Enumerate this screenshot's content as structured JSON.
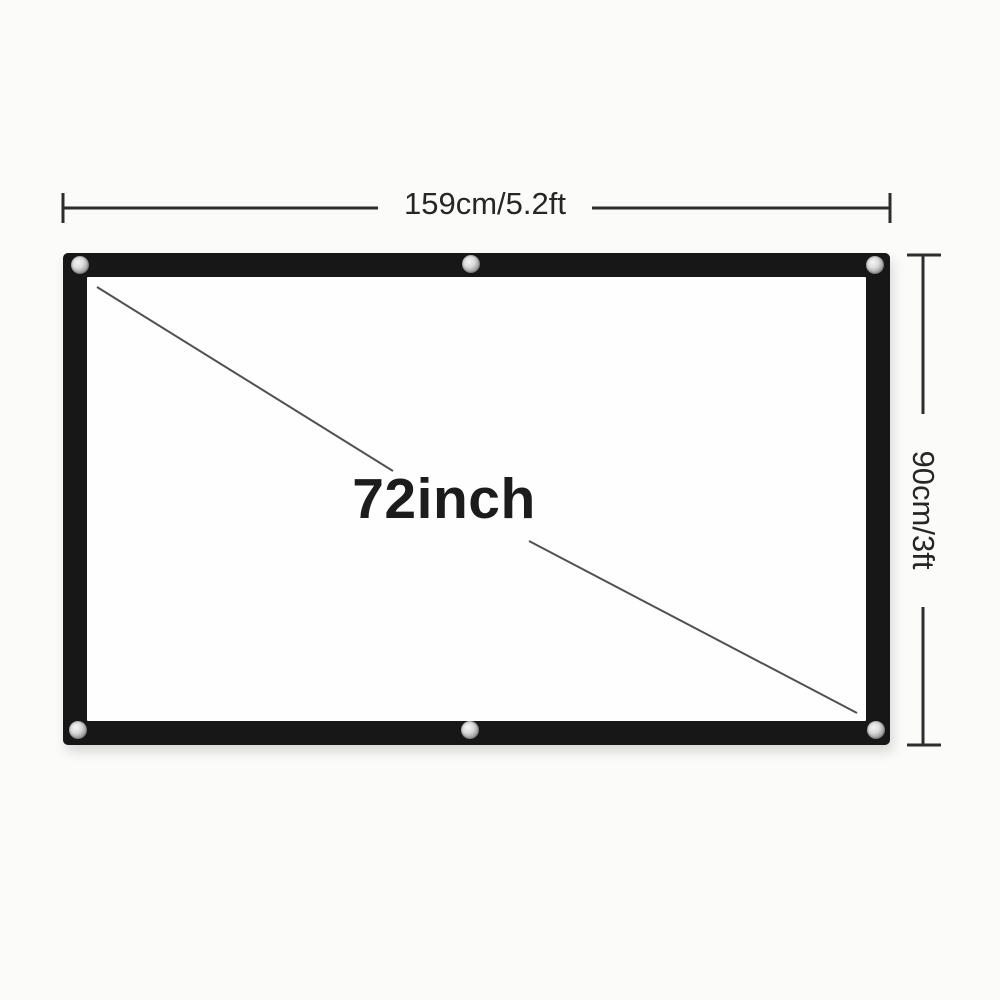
{
  "diagram": {
    "product": "projection-screen",
    "size_label": "72inch",
    "width_label": "159cm/5.2ft",
    "height_label": "90cm/3ft",
    "grommet_count": 6,
    "colors": {
      "background": "#fbfbfa",
      "frame": "#171717",
      "screen_surface": "#fefefe",
      "dimension_line": "#2d2d2d",
      "diagonal_line": "#515151",
      "label_text": "#262626"
    }
  }
}
